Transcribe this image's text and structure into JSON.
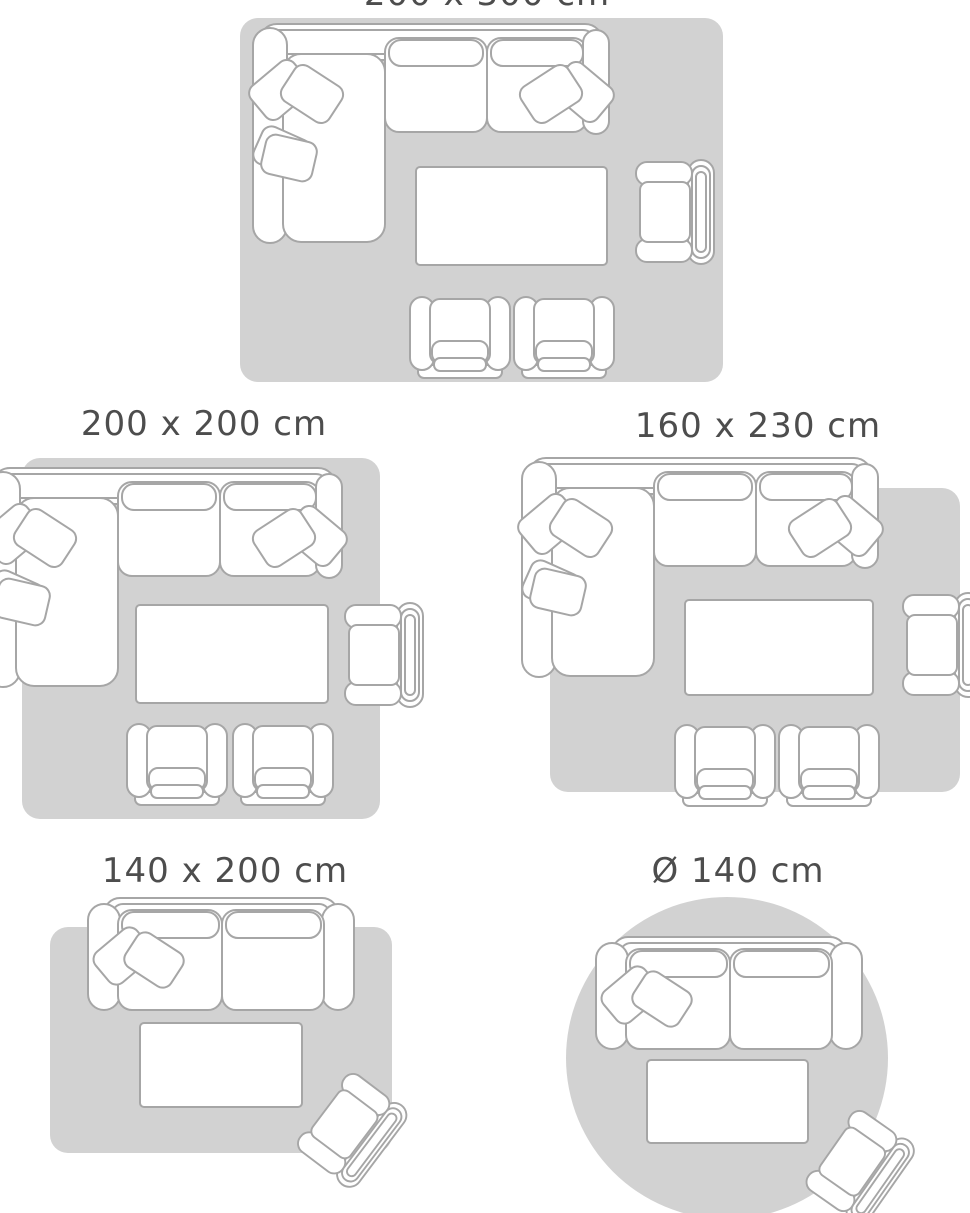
{
  "colors": {
    "background": "#ffffff",
    "rug": "#d2d2d2",
    "outline": "#a6a6a6",
    "furniture-fill": "#ffffff",
    "label-text": "#4d4d4d"
  },
  "sizes": [
    {
      "id": "200x300",
      "label": "200 x 300 cm",
      "rug_shape": "rectangle",
      "furniture": [
        "sectional-sofa",
        "coffee-table",
        "armchair",
        "chair",
        "chair"
      ]
    },
    {
      "id": "200x200",
      "label": "200 x 200 cm",
      "rug_shape": "rectangle",
      "furniture": [
        "sectional-sofa",
        "coffee-table",
        "armchair",
        "chair",
        "chair"
      ]
    },
    {
      "id": "160x230",
      "label": "160 x 230 cm",
      "rug_shape": "rectangle",
      "furniture": [
        "sectional-sofa",
        "coffee-table",
        "armchair",
        "chair",
        "chair"
      ]
    },
    {
      "id": "140x200",
      "label": "140 x 200 cm",
      "rug_shape": "rectangle",
      "furniture": [
        "loveseat-sofa",
        "coffee-table",
        "armchair"
      ]
    },
    {
      "id": "d140",
      "label": "Ø 140 cm",
      "rug_shape": "round",
      "furniture": [
        "loveseat-sofa",
        "coffee-table",
        "armchair"
      ]
    }
  ]
}
